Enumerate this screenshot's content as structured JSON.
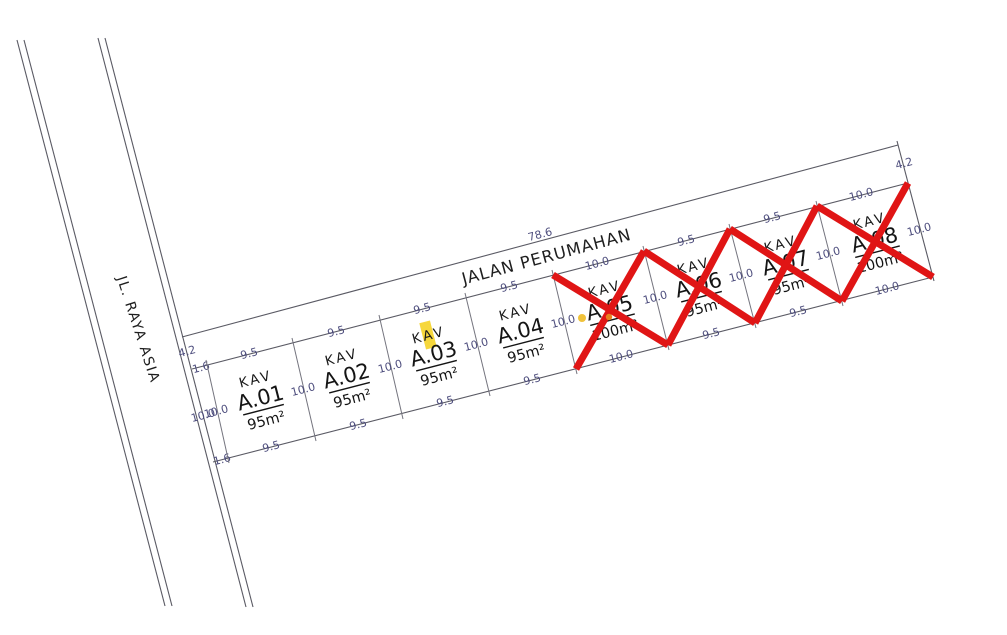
{
  "roads": {
    "main_road_label": "JL. RAYA ASIA",
    "front_road_label": "JALAN PERUMAHAN",
    "front_road_total_length": "78.6",
    "front_road_width_left": "4.2",
    "front_road_width_right": "4.2"
  },
  "strip": {
    "top_width": "1.6",
    "bottom_width": "1.6",
    "left_length": "10.0",
    "right_length": "10.0"
  },
  "plots": [
    {
      "kav_label": "KAV",
      "id": "A.01",
      "area": "95m²",
      "top_dim": "9.5",
      "bottom_dim": "9.5",
      "left_dim": "10.0",
      "status": "available"
    },
    {
      "kav_label": "KAV",
      "id": "A.02",
      "area": "95m²",
      "top_dim": "9.5",
      "bottom_dim": "9.5",
      "left_dim": "10.0",
      "status": "available"
    },
    {
      "kav_label": "KAV",
      "id": "A.03",
      "area": "95m²",
      "top_dim": "9.5",
      "bottom_dim": "9.5",
      "left_dim": "10.0",
      "status": "available"
    },
    {
      "kav_label": "KAV",
      "id": "A.04",
      "area": "95m²",
      "top_dim": "9.5",
      "bottom_dim": "9.5",
      "left_dim": "10.0",
      "status": "available"
    },
    {
      "kav_label": "KAV",
      "id": "A.05",
      "area": "100m²",
      "top_dim": "10.0",
      "bottom_dim": "10.0",
      "left_dim": "10.0",
      "status": "crossed-out"
    },
    {
      "kav_label": "KAV",
      "id": "A.06",
      "area": "95m²",
      "top_dim": "9.5",
      "bottom_dim": "9.5",
      "left_dim": "10.0",
      "status": "crossed-out"
    },
    {
      "kav_label": "KAV",
      "id": "A.07",
      "area": "95m²",
      "top_dim": "9.5",
      "bottom_dim": "9.5",
      "left_dim": "10.0",
      "status": "crossed-out"
    },
    {
      "kav_label": "KAV",
      "id": "A.08",
      "area": "100m²",
      "top_dim": "10.0",
      "bottom_dim": "10.0",
      "left_dim": "10.0",
      "right_dim": "10.0",
      "status": "crossed-out"
    }
  ],
  "colors": {
    "line": "#5a5a64",
    "dimension_text": "#4d4d7d",
    "plot_text": "#1a1a1a",
    "sold_cross": "#e01515",
    "highlight_yellow": "#f5d327",
    "marker_yellow": "#f0c23a",
    "marker_orange": "#e8821e",
    "background": "#ffffff"
  }
}
